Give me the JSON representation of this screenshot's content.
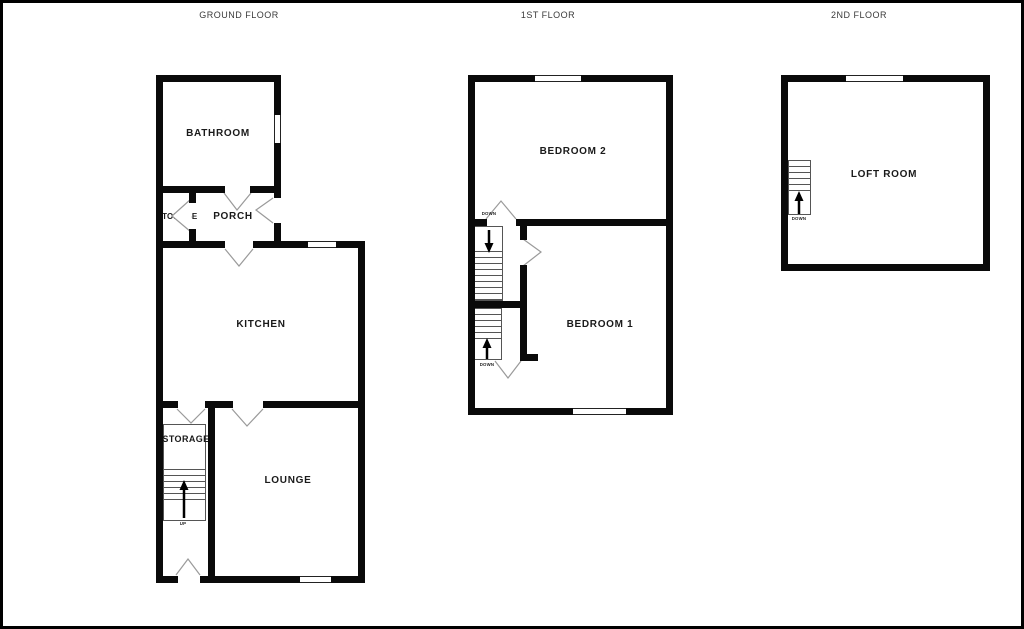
{
  "colors": {
    "background": "#ffffff",
    "wall": "#0a0a0a",
    "door_line": "#9a9a9a",
    "label_text": "#1a1a1a",
    "title_text": "#3a3a3a"
  },
  "floors": [
    {
      "id": "ground",
      "title": "GROUND FLOOR",
      "rooms": [
        {
          "id": "bathroom",
          "label": "BATHROOM"
        },
        {
          "id": "storage-top",
          "label": "STORAGE"
        },
        {
          "id": "porch",
          "label": "PORCH"
        },
        {
          "id": "kitchen",
          "label": "KITCHEN"
        },
        {
          "id": "storage-bottom",
          "label": "STORAGE"
        },
        {
          "id": "lounge",
          "label": "LOUNGE"
        }
      ],
      "stairs": [
        {
          "id": "ground-stairs",
          "direction_label": "UP",
          "arrow": "up-arrow-icon"
        }
      ]
    },
    {
      "id": "first",
      "title": "1ST FLOOR",
      "rooms": [
        {
          "id": "bedroom2",
          "label": "BEDROOM 2"
        },
        {
          "id": "bedroom1",
          "label": "BEDROOM 1"
        }
      ],
      "stairs": [
        {
          "id": "first-stairs-upper",
          "direction_label": "DOWN",
          "arrow": "down-arrow-icon"
        },
        {
          "id": "first-stairs-lower",
          "direction_label": "DOWN",
          "arrow": "up-arrow-icon"
        }
      ]
    },
    {
      "id": "second",
      "title": "2ND FLOOR",
      "rooms": [
        {
          "id": "loft",
          "label": "LOFT ROOM"
        }
      ],
      "stairs": [
        {
          "id": "second-stairs",
          "direction_label": "DOWN",
          "arrow": "up-arrow-icon"
        }
      ]
    }
  ]
}
